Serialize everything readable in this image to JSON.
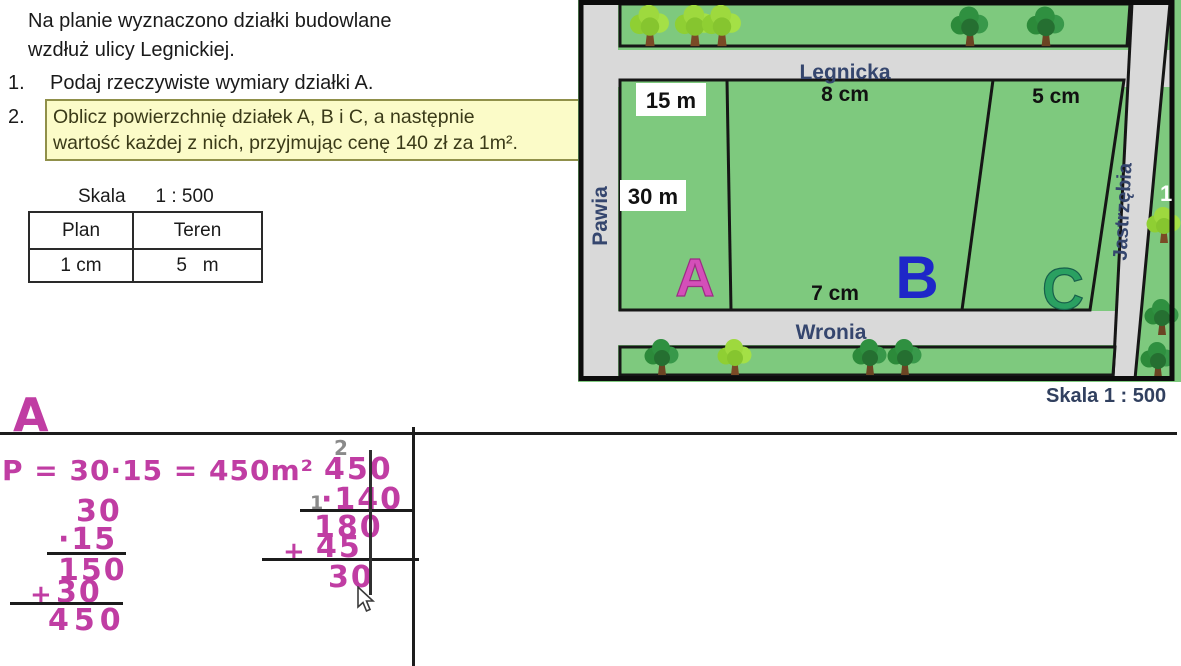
{
  "problem": {
    "intro_line1": "Na planie wyznaczono działki budowlane",
    "intro_line2": "wzdłuż ulicy Legnickiej.",
    "item1_num": "1.",
    "item1_text": "Podaj rzeczywiste wymiary działki A.",
    "item2_num": "2.",
    "item2_line1": "Oblicz powierzchnię działek A, B i C, a następnie",
    "item2_line2": "wartość każdej z nich, przyjmując cenę 140 zł za 1m²."
  },
  "scale": {
    "caption_label": "Skala",
    "caption_value": "1 : 500",
    "col1_header": "Plan",
    "col2_header": "Teren",
    "col1_value": "1 cm",
    "col2_value": "5   m"
  },
  "map": {
    "streets": {
      "top": "Legnicka",
      "bottom": "Wronia",
      "left": "Pawia",
      "right": "Jastrzębia"
    },
    "plots": {
      "a": "A",
      "b": "B",
      "c": "C"
    },
    "dims": {
      "a_width": "15 m",
      "a_height": "30 m",
      "b_top": "8 cm",
      "b_bottom": "7 cm",
      "c_top": "5 cm"
    },
    "scale_note": "Skala 1 : 500",
    "edge_mark": "1"
  },
  "solution": {
    "heading": "A",
    "formula": "P = 30·15 = 450m²",
    "calc1": {
      "row1": "30",
      "row2": "·15",
      "row3": "150",
      "plus": "+",
      "row4": "30",
      "result": "450"
    },
    "calc2": {
      "carry_top": "2",
      "row1": "450",
      "carry_mid": "1",
      "row2": "·140",
      "row3": "180",
      "plus": "+",
      "row4": "45",
      "row5": "30"
    }
  },
  "colors": {
    "map_green": "#7ec97e",
    "street_gray": "#d9d9d9",
    "label_navy": "#35466e",
    "plot_a_pink": "#d44fb9",
    "plot_b_blue": "#1e27c8",
    "plot_c_green": "#2aa061",
    "handwriting_magenta": "#c03da3",
    "highlight_yellow": "#fbfbc8"
  }
}
